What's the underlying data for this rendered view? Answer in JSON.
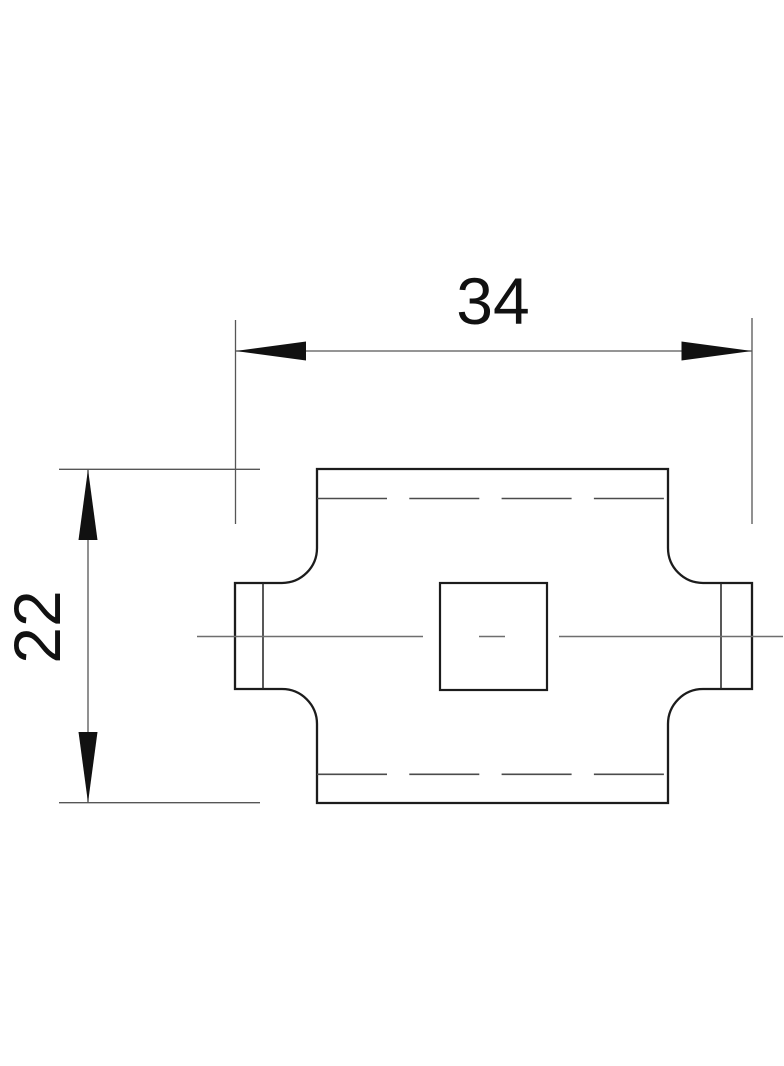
{
  "drawing": {
    "type": "technical-drawing-orthographic-view",
    "dimension_width": {
      "label": "34",
      "orientation": "horizontal"
    },
    "dimension_height": {
      "label": "22",
      "orientation": "vertical"
    },
    "colors": {
      "background": "#ffffff",
      "outline": "#1c1c1c",
      "inner_edge": "#2e2e2e",
      "hidden_line": "#4b4b4b",
      "centerline": "#6e6e6e",
      "dimension_line": "#565656",
      "extension_line": "#565656",
      "arrow": "#111111",
      "text": "#111111"
    }
  }
}
